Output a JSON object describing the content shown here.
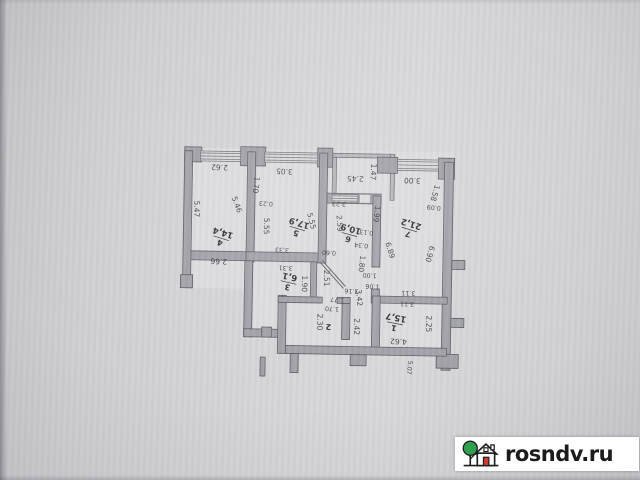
{
  "watermark": {
    "site_label": "rosndv.ru",
    "bg_color": "#ffffff",
    "text_color": "#1b1b1d",
    "tree_color": "#2fa14d",
    "door_color": "#d6392e",
    "outline_color": "#1f1f22"
  },
  "plan": {
    "wall_color": "#a1a1a8",
    "rooms": [
      {
        "number": "4",
        "area": "14,4",
        "cx": 221,
        "cy": 240,
        "rot": 196
      },
      {
        "number": "5",
        "area": "17,9",
        "cx": 297,
        "cy": 229,
        "rot": 196
      },
      {
        "number": "6",
        "area": "10,9",
        "cx": 349,
        "cy": 234,
        "rot": 194
      },
      {
        "number": "7",
        "area": "21,2",
        "cx": 409,
        "cy": 228,
        "rot": 196
      },
      {
        "number": "3",
        "area": "6,1",
        "cx": 289,
        "cy": 283,
        "rot": 192
      },
      {
        "number": "2",
        "area": "",
        "cx": 330,
        "cy": 322,
        "rot": 184
      },
      {
        "number": "1",
        "area": "15,7",
        "cx": 396,
        "cy": 322,
        "rot": 190
      }
    ],
    "dims": [
      {
        "t": "2.62",
        "x": 218,
        "y": 169,
        "r": 181
      },
      {
        "t": "1.70",
        "x": 255,
        "y": 186,
        "r": 95
      },
      {
        "t": "3.05",
        "x": 283,
        "y": 172,
        "r": 182
      },
      {
        "t": "0.23",
        "x": 265,
        "y": 204,
        "r": 182,
        "s": 1
      },
      {
        "t": "2.45",
        "x": 354,
        "y": 178,
        "r": 181
      },
      {
        "t": "1.47",
        "x": 372,
        "y": 171,
        "r": 92
      },
      {
        "t": "3.23",
        "x": 338,
        "y": 203,
        "r": 182,
        "s": 1
      },
      {
        "t": "3.00",
        "x": 411,
        "y": 179,
        "r": 181
      },
      {
        "t": "1.58",
        "x": 434,
        "y": 191,
        "r": 105
      },
      {
        "t": "0.09",
        "x": 433,
        "y": 205,
        "r": 185,
        "s": 1
      },
      {
        "t": "5.47",
        "x": 196,
        "y": 211,
        "r": 90
      },
      {
        "t": "5.46",
        "x": 236,
        "y": 206,
        "r": 68
      },
      {
        "t": "5.55",
        "x": 266,
        "y": 227,
        "r": 90
      },
      {
        "t": "5.55",
        "x": 311,
        "y": 221,
        "r": 75
      },
      {
        "t": "2.66",
        "x": 219,
        "y": 263,
        "r": 181
      },
      {
        "t": "3.33",
        "x": 282,
        "y": 250,
        "r": 182,
        "s": 1
      },
      {
        "t": "3.31",
        "x": 286,
        "y": 268,
        "r": 182,
        "s": 1
      },
      {
        "t": "1.90",
        "x": 305,
        "y": 284,
        "r": 90
      },
      {
        "t": "2.59",
        "x": 339,
        "y": 223,
        "r": 85
      },
      {
        "t": "0.60",
        "x": 329,
        "y": 252,
        "r": 183,
        "s": 1
      },
      {
        "t": "1.99",
        "x": 376,
        "y": 213,
        "r": 95
      },
      {
        "t": "0.13",
        "x": 366,
        "y": 231,
        "r": 185,
        "s": 1
      },
      {
        "t": "0.34",
        "x": 361,
        "y": 244,
        "r": 185,
        "s": 1
      },
      {
        "t": "1.80",
        "x": 362,
        "y": 263,
        "r": 95
      },
      {
        "t": "2.51",
        "x": 327,
        "y": 278,
        "r": 88
      },
      {
        "t": "1.00",
        "x": 370,
        "y": 274,
        "r": 182,
        "s": 1
      },
      {
        "t": "1.06",
        "x": 373,
        "y": 285,
        "r": 182,
        "s": 1
      },
      {
        "t": "3.16",
        "x": 352,
        "y": 290,
        "r": 182,
        "s": 1
      },
      {
        "t": "3.42",
        "x": 360,
        "y": 297,
        "r": 85
      },
      {
        "t": "1.77",
        "x": 338,
        "y": 299,
        "r": 182,
        "s": 1
      },
      {
        "t": "1.70",
        "x": 333,
        "y": 308,
        "r": 182,
        "s": 1
      },
      {
        "t": "6.89",
        "x": 390,
        "y": 249,
        "r": 72
      },
      {
        "t": "6.90",
        "x": 430,
        "y": 252,
        "r": 105
      },
      {
        "t": "2.30",
        "x": 321,
        "y": 322,
        "r": 90
      },
      {
        "t": "2.42",
        "x": 358,
        "y": 326,
        "r": 90
      },
      {
        "t": "3.11",
        "x": 409,
        "y": 291,
        "r": 181,
        "s": 1
      },
      {
        "t": "3.11",
        "x": 408,
        "y": 302,
        "r": 182,
        "s": 1
      },
      {
        "t": "2.25",
        "x": 430,
        "y": 322,
        "r": 90
      },
      {
        "t": "4.62",
        "x": 400,
        "y": 340,
        "r": 182
      },
      {
        "t": "5.07",
        "x": 411,
        "y": 366,
        "r": 95,
        "s": 1
      }
    ]
  }
}
